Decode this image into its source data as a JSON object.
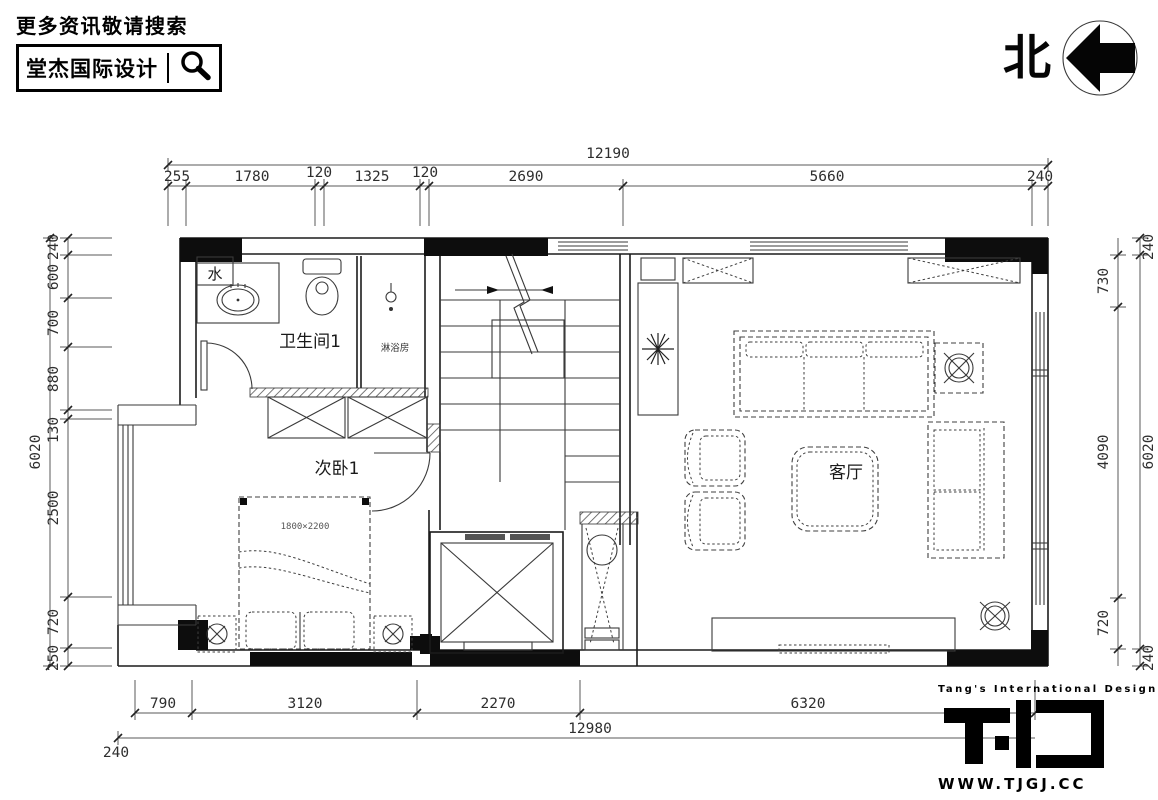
{
  "header": {
    "search_prompt": "更多资讯敬请搜索",
    "brand_name": "堂杰国际设计"
  },
  "compass": {
    "north_label": "北"
  },
  "plan": {
    "labels": {
      "water": "水",
      "bathroom": "卫生间1",
      "shower": "淋浴房",
      "bedroom": "次卧1",
      "living_room": "客厅",
      "bed_size": "1800×2200"
    }
  },
  "dimensions": {
    "top": {
      "overall": "12190",
      "segments": [
        "255",
        "1780",
        "120",
        "1325",
        "120",
        "2690",
        "5660",
        "240"
      ]
    },
    "left": {
      "overall": "6020",
      "segments": [
        "240",
        "600",
        "700",
        "880",
        "130",
        "2500",
        "720",
        "250"
      ]
    },
    "right": {
      "overall": "6020",
      "edge_top": "240",
      "edge_bottom": "240",
      "segments": [
        "730",
        "4090",
        "720"
      ]
    },
    "bottom": {
      "overall": "12980",
      "edge": "240",
      "segments": [
        "790",
        "3120",
        "2270",
        "6320"
      ]
    }
  },
  "footer": {
    "tagline": "Tang's International Design",
    "website": "WWW.TJGJ.CC"
  },
  "colors": {
    "line": "#3a3a3a",
    "wall": "#1c1c1c",
    "solid_fill": "#0d0d0d",
    "background": "#ffffff"
  }
}
